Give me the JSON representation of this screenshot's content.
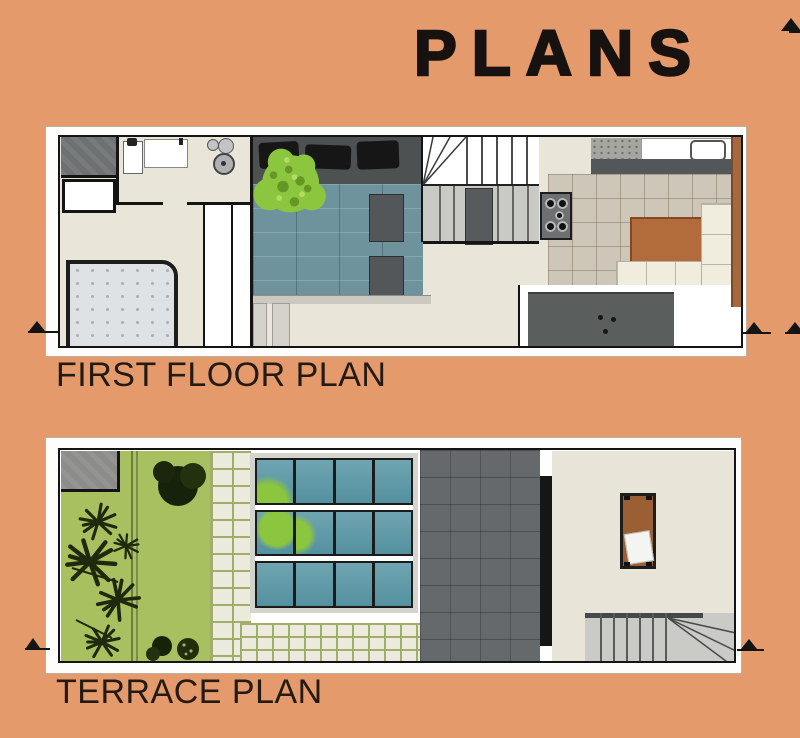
{
  "title": "PLANS",
  "plans": [
    {
      "id": "first-floor",
      "label": "FIRST FLOOR PLAN"
    },
    {
      "id": "terrace",
      "label": "TERRACE PLAN"
    }
  ],
  "icons": {
    "section_marker": "triangle-up-with-leader-line",
    "tree": "tree-canopy-top-view",
    "plants": "tropical-plants-top-view"
  },
  "colors": {
    "background": "#E49A6B",
    "ink": "#171210",
    "sheet": "#FDFDFC",
    "wall": "#141414",
    "floor_cream": "#E9E5D9",
    "tile_beige": "#CEC7B9",
    "teal_floor": "#6F939C",
    "glass_teal": "#5F9AA8",
    "lawn_green": "#A8C05F",
    "tree_green": "#8CC63F",
    "plant_dark": "#1E290D",
    "paver": "#ECE9DD",
    "paver_joint": "#9FAF69",
    "dark_gray": "#54575A",
    "deck_gray": "#65696B",
    "stair_gray": "#CACAC7",
    "wood_brown": "#B26B3A",
    "bed_gray": "#DFE2E5"
  }
}
